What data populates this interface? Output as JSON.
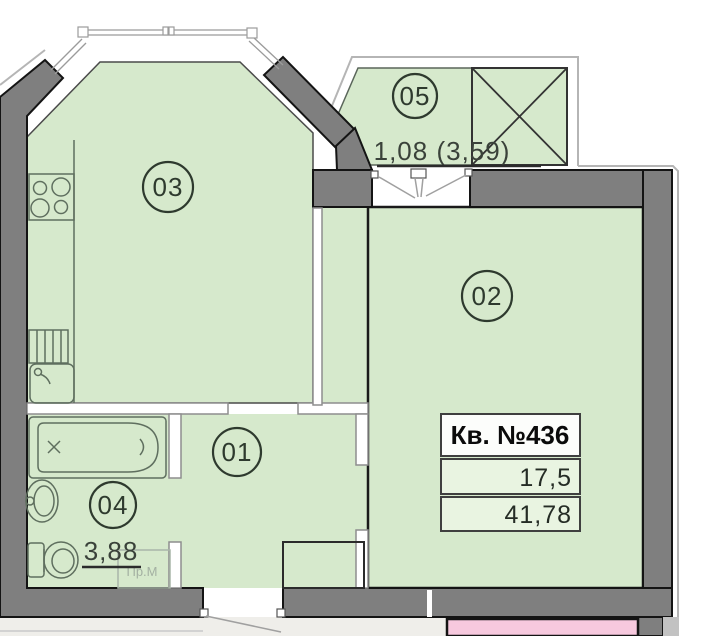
{
  "plan": {
    "apartment": {
      "title": "Кв. №436",
      "living_area": "17,5",
      "total_area": "41,78"
    },
    "rooms": {
      "r01": {
        "label": "01"
      },
      "r02": {
        "label": "02"
      },
      "r03": {
        "label": "03"
      },
      "r04": {
        "label": "04",
        "area": "3,88"
      },
      "r05": {
        "label": "05",
        "area": "1,08 (3,59)"
      }
    },
    "annotations": {
      "washing_machine": "Пр.М"
    },
    "colors": {
      "room_fill": "#d6e9cc",
      "wall_fill": "#7f7f7f",
      "adjacent_room_fill": "#f7c9de",
      "corridor_fill": "#efeeea"
    }
  }
}
